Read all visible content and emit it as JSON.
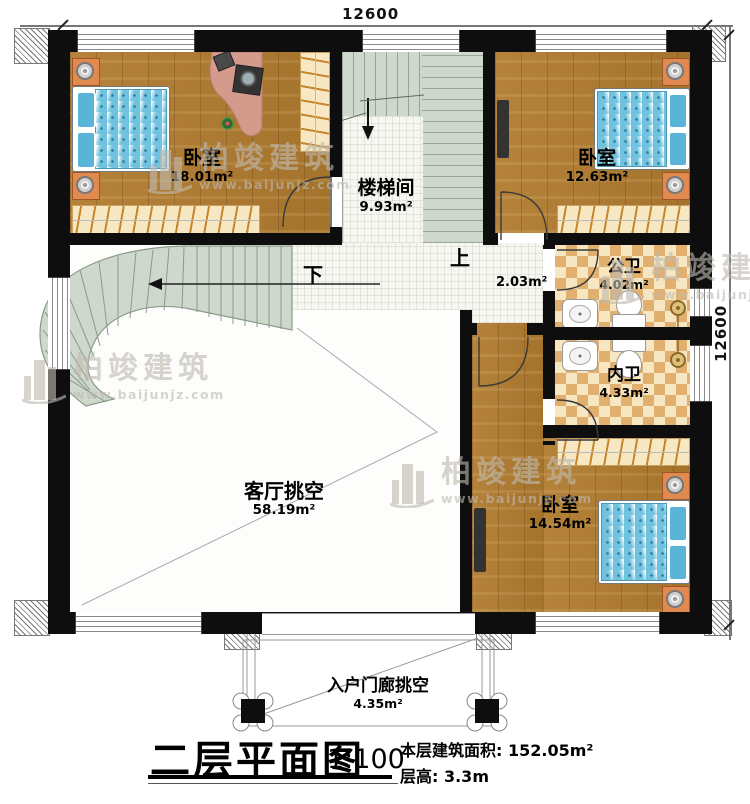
{
  "document": {
    "type_label": "二层平面图",
    "scale": "1:100",
    "building_area": "本层建筑面积: 152.05m²",
    "floor_height": "层高: 3.3m"
  },
  "dimensions": {
    "top": "12600",
    "right": "12600"
  },
  "rooms": {
    "bedroom_top_left": {
      "name": "卧室",
      "area": "18.01m²"
    },
    "bedroom_top_right": {
      "name": "卧室",
      "area": "12.63m²"
    },
    "bedroom_bottom_right": {
      "name": "卧室",
      "area": "14.54m²"
    },
    "stairwell": {
      "name": "楼梯间",
      "area": "9.93m²"
    },
    "public_bathroom": {
      "name": "公卫",
      "area": "4.02m²"
    },
    "private_bathroom": {
      "name": "内卫",
      "area": "4.33m²"
    },
    "living_room_void": {
      "name": "客厅挑空",
      "area": "58.19m²"
    },
    "entry_porch_void": {
      "name": "入户门廊挑空",
      "area": "4.35m²"
    },
    "hallway": {
      "area": "2.03m²"
    }
  },
  "stairs": {
    "up_label": "上",
    "down_label": "下"
  },
  "watermark": {
    "brand": "柏竣建筑",
    "website": "www.baijunjz.com"
  },
  "colors": {
    "wall": "#0e0e0e",
    "wood_floor": "#ae7c33",
    "stair_tread": "#cfd8cc",
    "tile_floor": "#f7f7f2",
    "bathroom_tile_a": "#e2b06e",
    "bathroom_tile_b": "#f6e6c2",
    "bed_blue": "#70c2de",
    "nightstand_orange": "#e08a50",
    "closet_tan": "#f7e7c2",
    "watermark_grey": "#bebab0"
  }
}
